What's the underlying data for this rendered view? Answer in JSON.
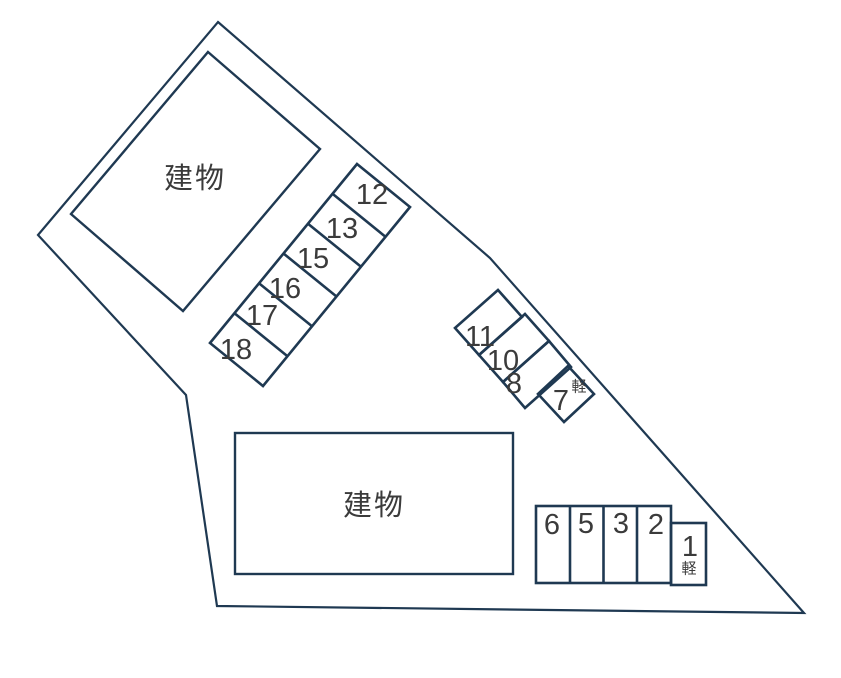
{
  "diagram": {
    "building_label": "建物",
    "kei_label": "軽",
    "upper_strip": {
      "spaces": [
        "12",
        "13",
        "15",
        "16",
        "17",
        "18"
      ]
    },
    "middle_block": {
      "spaces": [
        "11",
        "10",
        "8",
        "7"
      ],
      "kei_space": "7"
    },
    "bottom_row": {
      "spaces": [
        "6",
        "5",
        "3",
        "2",
        "1"
      ],
      "kei_space": "1"
    },
    "colors": {
      "line": "#1f3952",
      "text": "#3b3b3b",
      "background": "#ffffff"
    }
  }
}
